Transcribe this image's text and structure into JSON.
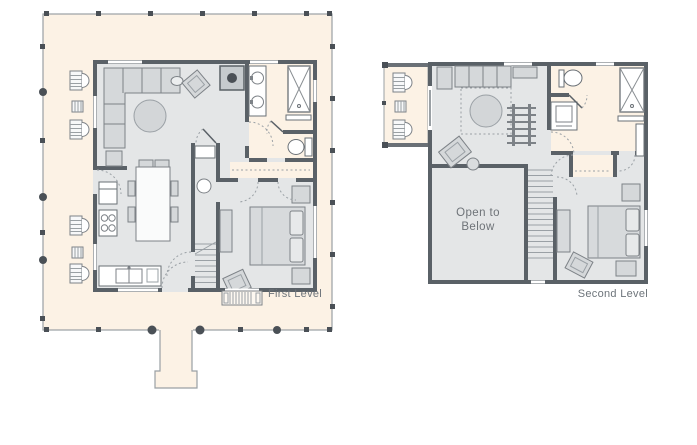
{
  "sheet": {
    "background": "#ffffff"
  },
  "colors": {
    "porch_floor": "#fcf2e5",
    "interior_floor": "#e4e6e7",
    "wall": "#5a6167",
    "furniture_fill": "#d5d8da",
    "furniture_stroke": "#7d8287",
    "fixture_white": "#ffffff",
    "post_dark": "#4a5056",
    "label_text": "#6d747a"
  },
  "first_level": {
    "label": "First Level"
  },
  "second_level": {
    "label": "Second Level",
    "open_to_line1": "Open to",
    "open_to_line2": "Below"
  }
}
